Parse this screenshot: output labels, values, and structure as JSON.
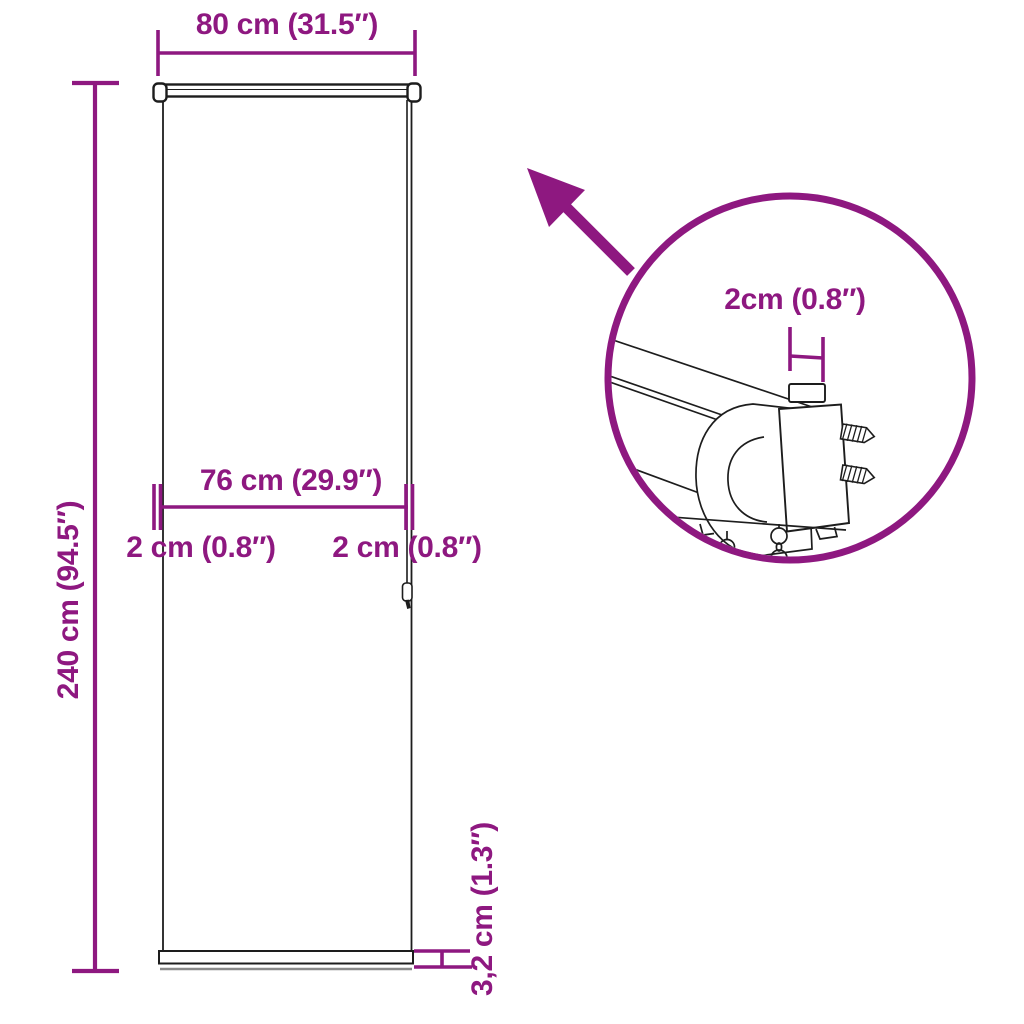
{
  "colors": {
    "accent": "#8E1880",
    "line": "#1d1d1d",
    "shadow_line": "#8a8a8a",
    "background": "#ffffff"
  },
  "icons": {
    "zoom_arrow": "arrow-up-left-icon",
    "detail_magnifier": "detail-circle-callout"
  },
  "front_view": {
    "total_width_label": "80 cm (31.5″)",
    "total_height_label": "240 cm (94.5″)",
    "fabric_width_label": "76 cm (29.9″)",
    "left_margin_label": "2 cm (0.8″)",
    "right_margin_label": "2 cm (0.8″)",
    "slat_thickness_label": "3,2 cm (1.3″)"
  },
  "detail_view": {
    "bracket_depth_label": "2cm (0.8″)"
  }
}
